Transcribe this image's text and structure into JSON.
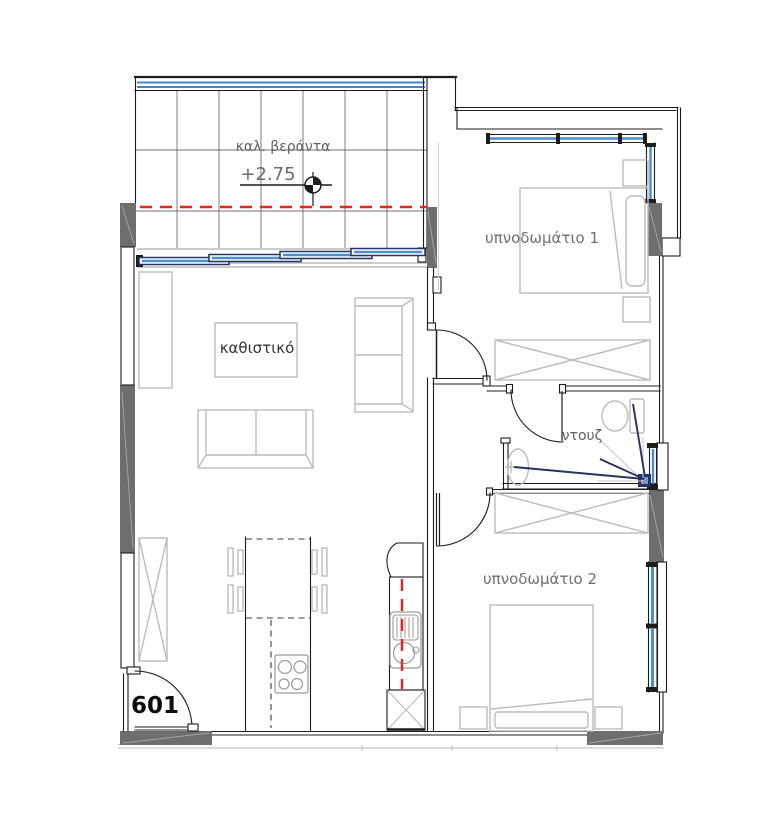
{
  "plan": {
    "unit_number": "601",
    "rooms": {
      "veranda": {
        "label": "καλ. βεράντα",
        "elevation": "+2.75"
      },
      "bedroom1": {
        "label": "υπνοδωμάτιο 1"
      },
      "living": {
        "label": "καθιστικό"
      },
      "shower": {
        "label": "ντουζ"
      },
      "bedroom2": {
        "label": "υπνοδωμάτιο 2"
      }
    },
    "colors": {
      "wall_line": "#1c1c1c",
      "wall_fill": "#6e6e6e",
      "furniture": "#bcbcbc",
      "glazing_blue": "#4a8fd4",
      "window_frame_navy": "#25335f",
      "railing_blue": "#3e87cc",
      "axis_red": "#e8251d",
      "tile_grid": "#707070",
      "label_text": "#6f6f6f"
    }
  }
}
